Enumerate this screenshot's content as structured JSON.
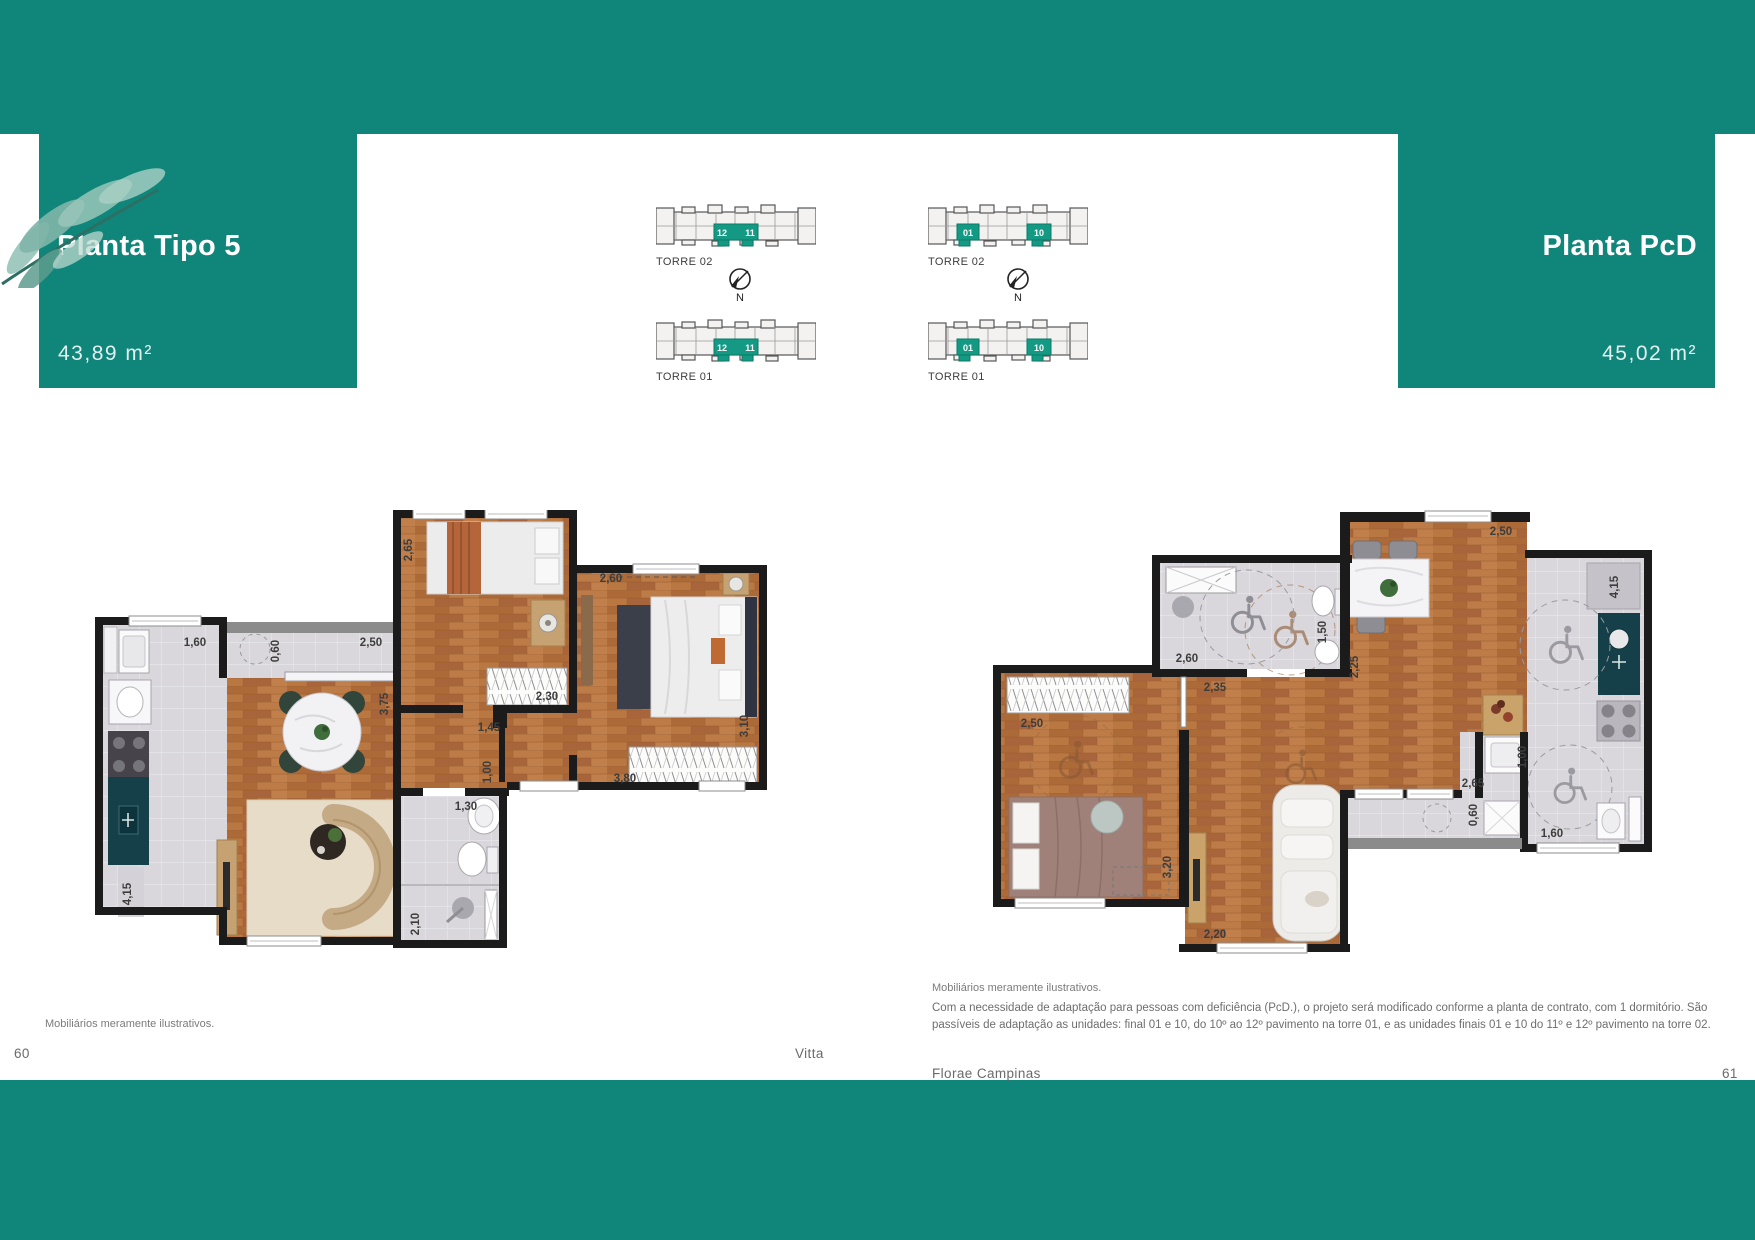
{
  "colors": {
    "teal": "#10857a",
    "tower_highlight": "#149a84",
    "wall": "#1b1b1b",
    "wood": "#b4713f",
    "tile": "#d9d7db",
    "counter_teal": "#15404a"
  },
  "left_page": {
    "title": "Planta Tipo 5",
    "area": "43,89 m²",
    "towers": [
      {
        "label": "TORRE 02",
        "units": [
          "12",
          "11"
        ]
      },
      {
        "label": "TORRE 01",
        "units": [
          "12",
          "11"
        ]
      }
    ],
    "compass": "N",
    "dims": {
      "kitchen_width": "1,60",
      "balcony_depth": "0,60",
      "balcony_width": "2,50",
      "bedroom1_width": "2,65",
      "bedroom2_top": "2,60",
      "living_height": "3,75",
      "wardrobe1": "2,30",
      "hall_width": "1,45",
      "hall_depth": "1,00",
      "bedroom2_height": "3,10",
      "wardrobe2": "3,80",
      "bath_width": "1,30",
      "bath_height": "2,10",
      "kitchen_height": "4,15"
    },
    "footnote": "Mobiliários meramente ilustrativos.",
    "page_number": "60",
    "brand_footer": "Vitta"
  },
  "right_page": {
    "title": "Planta PcD",
    "area": "45,02 m²",
    "towers": [
      {
        "label": "TORRE 02",
        "units": [
          "01",
          "10"
        ]
      },
      {
        "label": "TORRE 01",
        "units": [
          "01",
          "10"
        ]
      }
    ],
    "compass": "N",
    "dims": {
      "dining_top": "2,50",
      "kitchen_counter": "4,15",
      "bath_width": "2,60",
      "bath_door": "1,50",
      "dining_left": "2,25",
      "hall": "2,35",
      "wardrobe": "2,50",
      "bedroom_wall": "3,20",
      "living_width": "2,20",
      "balcony_top": "2,65",
      "balcony_depth": "0,60",
      "laundry": "1,00",
      "service": "1,60"
    },
    "footnote": "Mobiliários meramente ilustrativos.",
    "disclaimer": "Com a necessidade de adaptação para pessoas com deficiência (PcD.), o projeto será modificado conforme a planta de contrato, com 1 dormitório. São passíveis de adaptação as unidades: final 01 e 10, do 10º ao 12º pavimento na torre 01, e as unidades finais 01 e 10 do 11º e 12º pavimento na torre 02.",
    "project_footer": "Florae Campinas",
    "page_number": "61"
  }
}
